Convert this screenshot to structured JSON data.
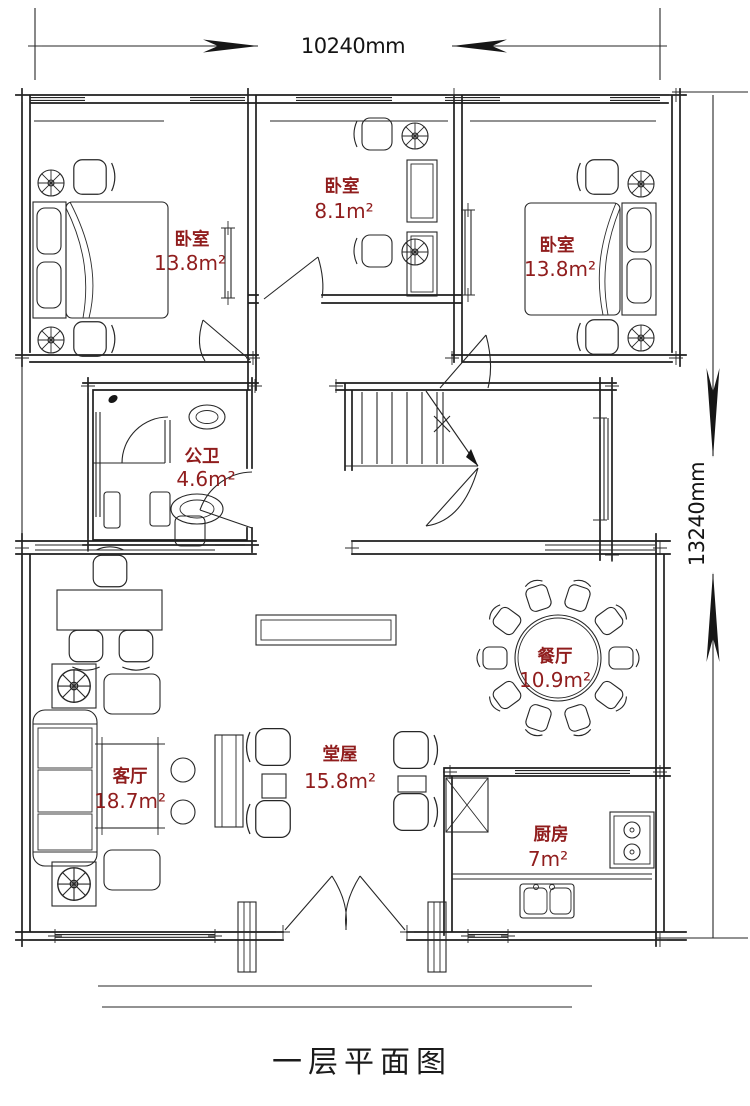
{
  "title": "一层平面图",
  "dimensions": {
    "width_label": "10240mm",
    "height_label": "13240mm"
  },
  "rooms": {
    "bedroom_left": {
      "name": "卧室",
      "area": "13.8m²"
    },
    "bedroom_middle": {
      "name": "卧室",
      "area": "8.1m²"
    },
    "bedroom_right": {
      "name": "卧室",
      "area": "13.8m²"
    },
    "bathroom": {
      "name": "公卫",
      "area": "4.6m²"
    },
    "dining_room": {
      "name": "餐厅",
      "area": "10.9m²"
    },
    "living_room": {
      "name": "客厅",
      "area": "18.7m²"
    },
    "main_hall": {
      "name": "堂屋",
      "area": "15.8m²"
    },
    "kitchen": {
      "name": "厨房",
      "area": "7m²"
    }
  },
  "colors": {
    "wall_line": "#1e1e1e",
    "room_label": "#901d1d",
    "background": "#ffffff"
  }
}
